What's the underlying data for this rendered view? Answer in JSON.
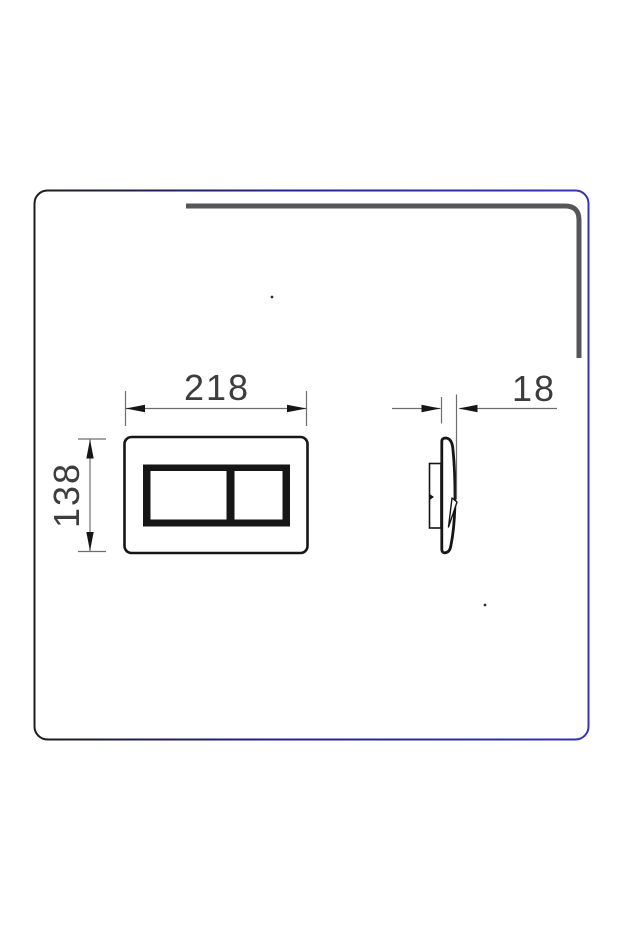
{
  "drawing": {
    "subject": "flush plate dimension drawing, front and side views",
    "width_label": "218",
    "height_label": "138",
    "depth_label": "18"
  },
  "colors": {
    "panel_border_left": "#1c1c1c",
    "panel_border_right": "#3434b2",
    "shadow_line": "#55555a",
    "drawing_line": "#161616",
    "dimension_line": "#6e6e6e",
    "label_text": "#3d3d3d",
    "background": "#ffffff"
  }
}
